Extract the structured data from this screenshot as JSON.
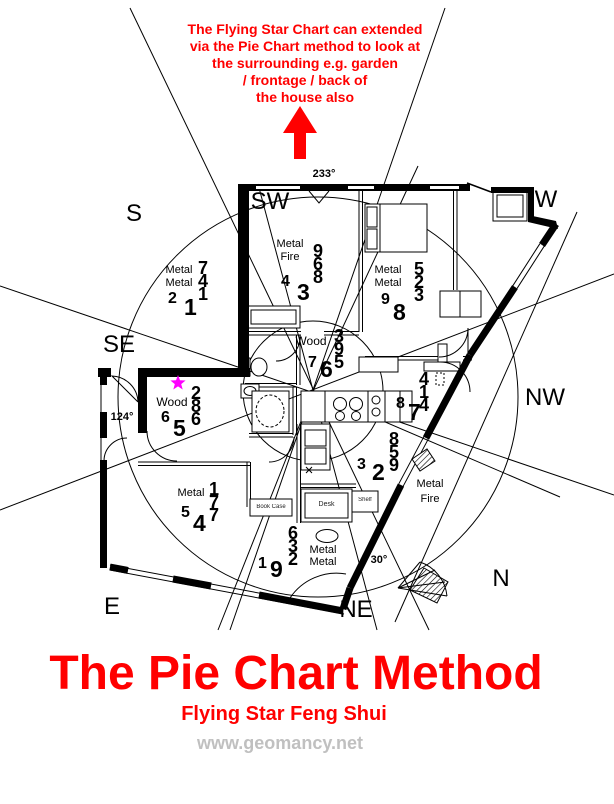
{
  "annotation": {
    "lines": [
      "The Flying Star Chart can extended",
      "via the Pie Chart method to look at",
      "the surrounding e.g. garden",
      "/ frontage / back of",
      "the house also"
    ]
  },
  "compass": {
    "s": "S",
    "sw": "SW",
    "w": "W",
    "se": "SE",
    "nw": "NW",
    "e": "E",
    "ne": "NE",
    "n": "N"
  },
  "angles": {
    "southwest": "233°",
    "southeast": "124°",
    "northeast": "30°"
  },
  "sectors": [
    {
      "id": "south-outside",
      "elements": [
        "Metal",
        "Metal"
      ],
      "stars": [
        "7",
        "4",
        "1"
      ],
      "period": [
        "2",
        "1"
      ]
    },
    {
      "id": "southwest-room",
      "elements": [
        "Metal",
        "Fire"
      ],
      "stars": [
        "9",
        "6",
        "8"
      ],
      "period": [
        "4",
        "3"
      ]
    },
    {
      "id": "west-room",
      "elements": [
        "Metal",
        "Metal"
      ],
      "stars": [
        "5",
        "2",
        "3"
      ],
      "period": [
        "9",
        "8"
      ]
    },
    {
      "id": "center-wood",
      "elements": [
        "Wood"
      ],
      "stars": [
        "3",
        "9",
        "5"
      ],
      "period": [
        "7",
        "6"
      ]
    },
    {
      "id": "northwest-side",
      "elements": [],
      "stars": [
        "4",
        "1",
        "4"
      ],
      "period": [
        "8",
        "7"
      ]
    },
    {
      "id": "north-inner",
      "elements": [],
      "stars": [
        "8",
        "5",
        "9"
      ],
      "period": [
        "3",
        "2"
      ]
    },
    {
      "id": "southeast-room",
      "elements": [
        "Wood"
      ],
      "stars": [
        "2",
        "8",
        "6"
      ],
      "period": [
        "6",
        "5"
      ]
    },
    {
      "id": "east-room",
      "elements": [
        "Metal"
      ],
      "stars": [
        "1",
        "7",
        "7"
      ],
      "period": [
        "5",
        "4"
      ]
    },
    {
      "id": "northeast-room",
      "elements": [
        "Metal",
        "Metal"
      ],
      "stars": [
        "6",
        "3",
        "2"
      ],
      "period": [
        "1",
        "9"
      ]
    },
    {
      "id": "north-outside",
      "elements": [
        "Metal",
        "Fire"
      ],
      "stars": [],
      "period": []
    }
  ],
  "furniture": {
    "desk": "Desk",
    "bookcase": "Book Case",
    "shelf": "Shelf"
  },
  "footer": {
    "title": "The Pie Chart Method",
    "subtitle": "Flying Star Feng Shui",
    "website": "www.geomancy.net"
  },
  "colors": {
    "accent": "#ff0000",
    "star_marker": "#ff00ff",
    "website_gray": "#c0c0c0",
    "ink": "#000000"
  }
}
